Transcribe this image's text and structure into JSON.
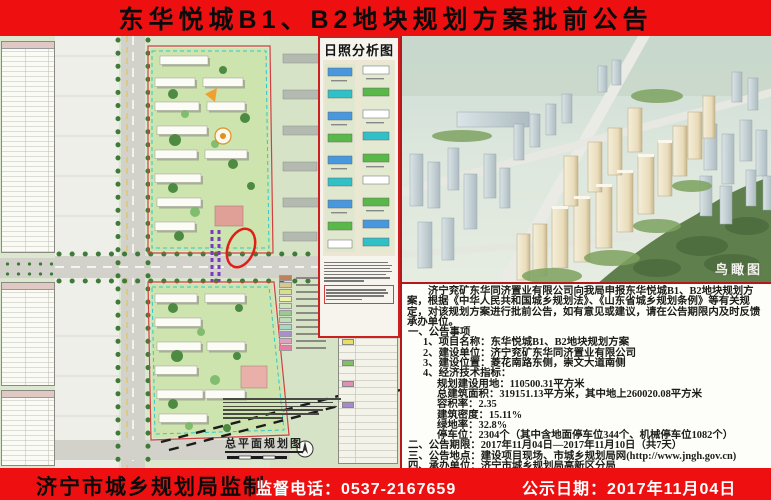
{
  "banner": {
    "title": "东华悦城B1、B2地块规划方案批前公告",
    "bg_color": "#ee1010",
    "title_color": "#0b0b0b"
  },
  "master_plan": {
    "label": "总平面规划图",
    "annotation": "red-ellipse-highlight",
    "legend_colors": [
      "#c08058",
      "#d8c890",
      "#d8e088",
      "#f0f0a8",
      "#cfe3bc",
      "#9cc894",
      "#bce0b4",
      "#a8d8c4",
      "#a890d0",
      "#e0a0c4",
      "#e87ea8"
    ],
    "legendB_cells": [
      "#e8e060",
      "#80c060",
      "#e090b8",
      "#a888d0"
    ]
  },
  "sunshine": {
    "title": "日照分析图"
  },
  "aerial": {
    "label": "鸟瞰图"
  },
  "notice": {
    "intro": "济宁兖矿东华同济置业有限公司向我局申报东华悦城B1、B2地块规划方案，根据《中华人民共和国城乡规划法》、《山东省城乡规划条例》等有关规定，对该规划方案进行批前公告，如有意见或建议，请在公告期限内及时反馈承办单位。",
    "lines": [
      {
        "indent": 0,
        "text": "一、公告事项"
      },
      {
        "indent": 1,
        "text": "1、项目名称：东华悦城B1、B2地块规划方案"
      },
      {
        "indent": 1,
        "text": "2、建设单位：济宁兖矿东华同济置业有限公司"
      },
      {
        "indent": 1,
        "text": "3、建设位置：菱花南路东侧，崇文大道南侧"
      },
      {
        "indent": 1,
        "text": "4、经济技术指标："
      },
      {
        "indent": 2,
        "text": "规划建设用地：110500.31平方米"
      },
      {
        "indent": 2,
        "text": "总建筑面积：319151.13平方米，其中地上260020.08平方米"
      },
      {
        "indent": 2,
        "text": "容积率：2.35"
      },
      {
        "indent": 2,
        "text": "建筑密度：15.11%"
      },
      {
        "indent": 2,
        "text": "绿地率：32.8%"
      },
      {
        "indent": 2,
        "text": "停车位：2304个（其中含地面停车位344个、机械停车位1082个）"
      },
      {
        "indent": 0,
        "text": "二、公告期限：2017年11月04日—2017年11月10日（共7天）"
      },
      {
        "indent": 0,
        "text": "三、公告地点：建设项目现场、市城乡规划局网(http://www.jngh.gov.cn)"
      },
      {
        "indent": 0,
        "text": "四、承办单位：济宁市城乡规划局高新区分局"
      },
      {
        "indent": 0,
        "text": "联系电话：0537-3255128　　办公地址：海川路009号产学研基地A1楼305室"
      }
    ]
  },
  "footer": {
    "maker": "济宁市城乡规划局监制",
    "phone": "监督电话：0537-2167659",
    "date": "公示日期：2017年11月04日"
  }
}
